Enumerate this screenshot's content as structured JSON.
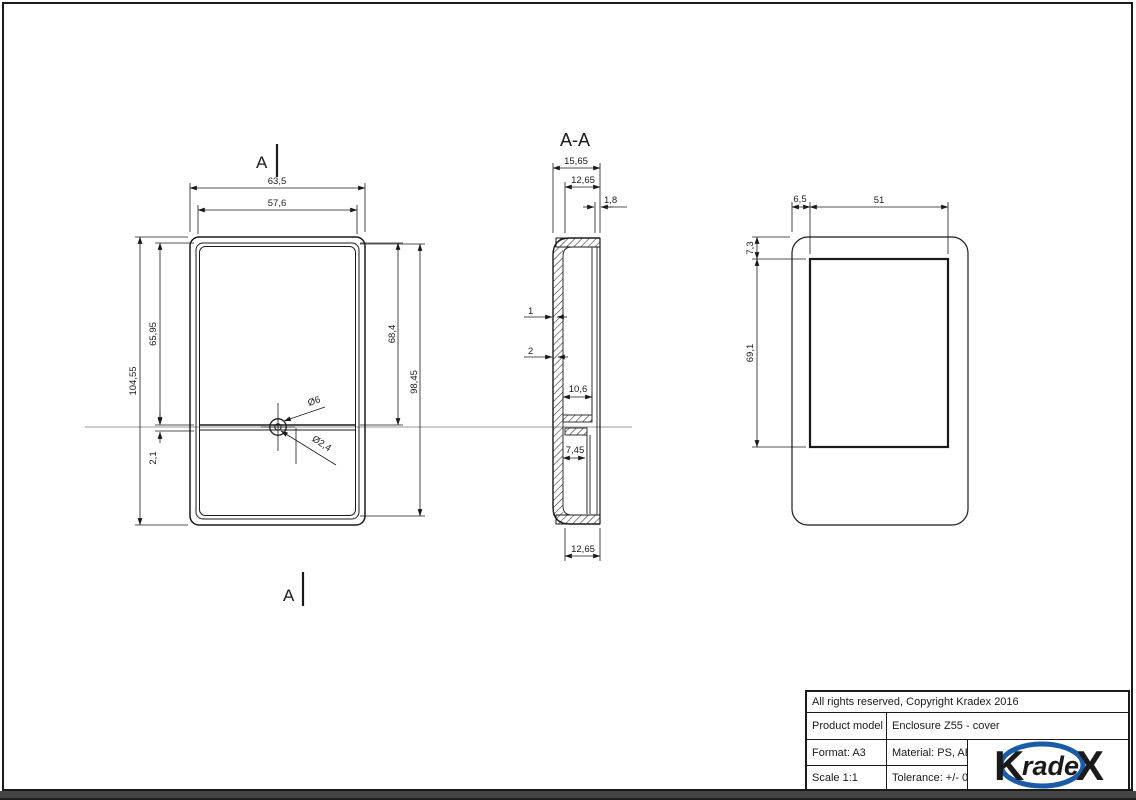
{
  "front_view": {
    "section_marker_top": "A",
    "section_marker_bottom": "A",
    "dim_outer_width": "63,5",
    "dim_inner_width": "57,6",
    "dim_upper_height": "65,95",
    "dim_total_height": "104,55",
    "dim_step": "2,1",
    "dim_right_upper": "68,4",
    "dim_right_total": "98,45",
    "dim_hole_outer": "Ø6",
    "dim_hole_inner": "Ø2,4"
  },
  "section_view": {
    "title": "A-A",
    "dim_outer_depth": "15,65",
    "dim_inner_depth": "12,65",
    "dim_lip": "1,8",
    "dim_wall_top": "1",
    "dim_wall_bottom": "2",
    "dim_shelf": "10,6",
    "dim_boss": "7,45",
    "dim_bottom_depth": "12,65"
  },
  "rear_view": {
    "dim_side_offset": "6,5",
    "dim_panel_width": "51",
    "dim_top_offset": "7,3",
    "dim_panel_height": "69,1"
  },
  "title_block": {
    "copyright": "All rights reserved, Copyright Kradex 2016",
    "product_label": "Product model",
    "product_value": "Enclosure Z55 - cover",
    "format": "Format: A3",
    "material": "Material: PS, ABS",
    "scale": "Scale 1:1",
    "tolerance": "Tolerance: +/- 0.6",
    "logo": {
      "k": "K",
      "rade": "rade",
      "x": "X",
      "color": "#1b5ca8"
    }
  }
}
